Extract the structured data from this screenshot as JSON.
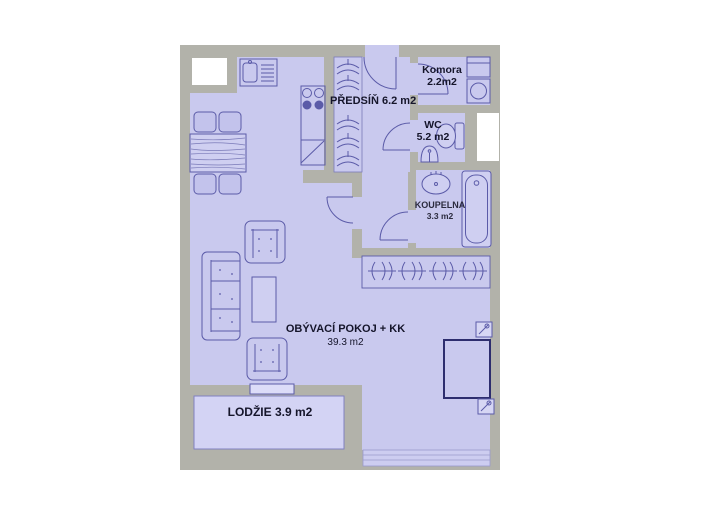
{
  "plan": {
    "type": "apartment-floor-plan",
    "rooms": {
      "predsin": {
        "label": "PŘEDSÍŇ 6.2 m2"
      },
      "komora": {
        "name": "Komora",
        "area": "2.2m2"
      },
      "wc": {
        "name": "WC",
        "area": "5.2 m2"
      },
      "koupelna": {
        "name": "KOUPELNA",
        "area": "3.3 m2"
      },
      "obyvaci": {
        "name": "OBÝVACÍ POKOJ + KK",
        "area": "39.3 m2"
      },
      "lodzie": {
        "label": "LODŽIE 3.9 m2"
      }
    },
    "colors": {
      "background": "#ffffff",
      "wall": "#b2b2aa",
      "room_fill": "#c9c9ee",
      "loggia_fill": "#d3d3f4",
      "furniture_outline": "#5b5ba8",
      "bed_outline": "#2d2d6e",
      "window": "#ffffff",
      "text": "#15152a"
    }
  }
}
